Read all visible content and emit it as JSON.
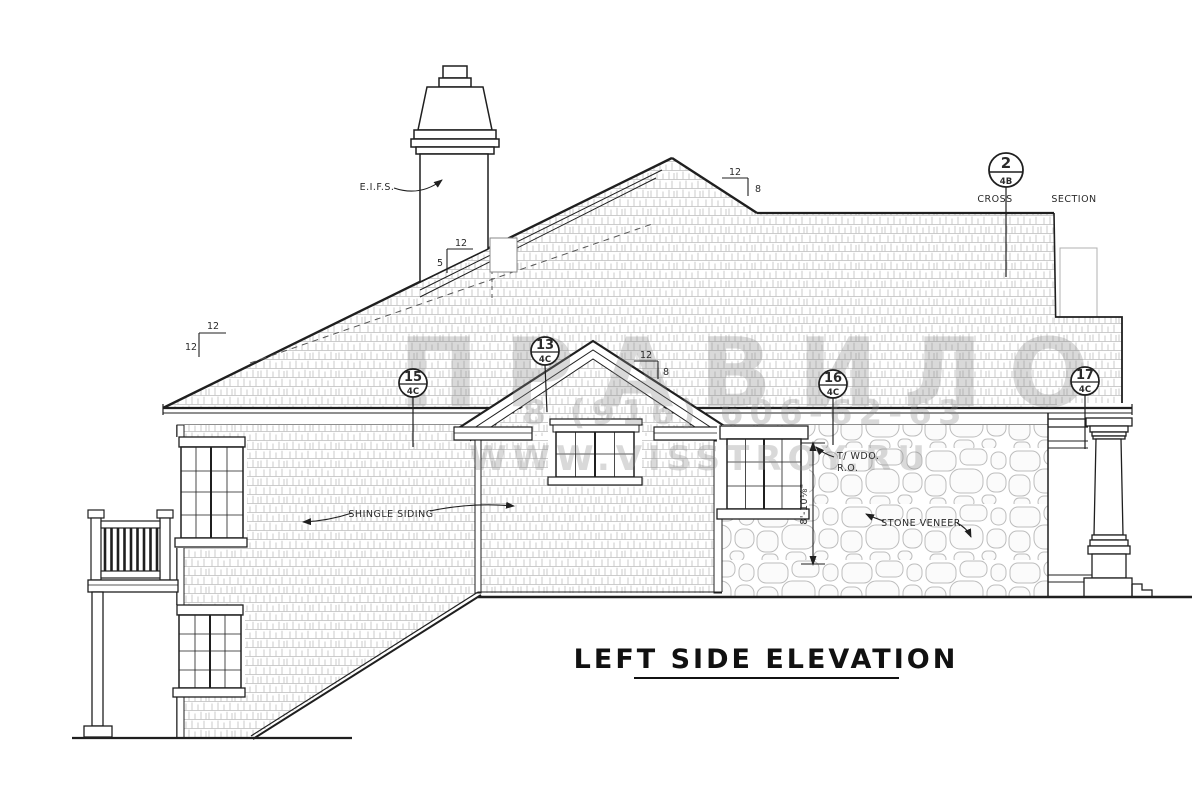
{
  "document": {
    "title": "LEFT SIDE ELEVATION"
  },
  "annotations": {
    "eifs": "E.I.F.S.",
    "shingle_siding": "SHINGLE SIDING",
    "stone_veneer": "STONE VENEER",
    "top_of_window": "T/ WDO.",
    "rough_opening": "R.O.",
    "cross": "CROSS",
    "section": "SECTION",
    "window_height_dim": "8'-10⅛\""
  },
  "callouts": {
    "cross_section": {
      "number": "2",
      "sheet": "4B"
    },
    "c15": {
      "number": "15",
      "sheet": "4C"
    },
    "c13": {
      "number": "13",
      "sheet": "4C"
    },
    "c16": {
      "number": "16",
      "sheet": "4C"
    },
    "c17": {
      "number": "17",
      "sheet": "4C"
    }
  },
  "pitch_marks": {
    "left_hip": {
      "run": "12",
      "rise": "12"
    },
    "chimney": {
      "run": "12",
      "rise": "5"
    },
    "main_roof": {
      "run": "12",
      "rise": "8"
    },
    "gable": {
      "run": "12",
      "rise": "8"
    }
  },
  "watermark": {
    "line1": "ПРАВИЛО",
    "line2": "8 (916) 606-62-63",
    "line3": "WWW.VISSTROY.RU"
  },
  "colors": {
    "ink": "#1f1f1f",
    "texture": "#c6c6c6",
    "stone_outline": "#bdbdbd",
    "watermark": "#8a8a8a",
    "paper": "#ffffff"
  }
}
